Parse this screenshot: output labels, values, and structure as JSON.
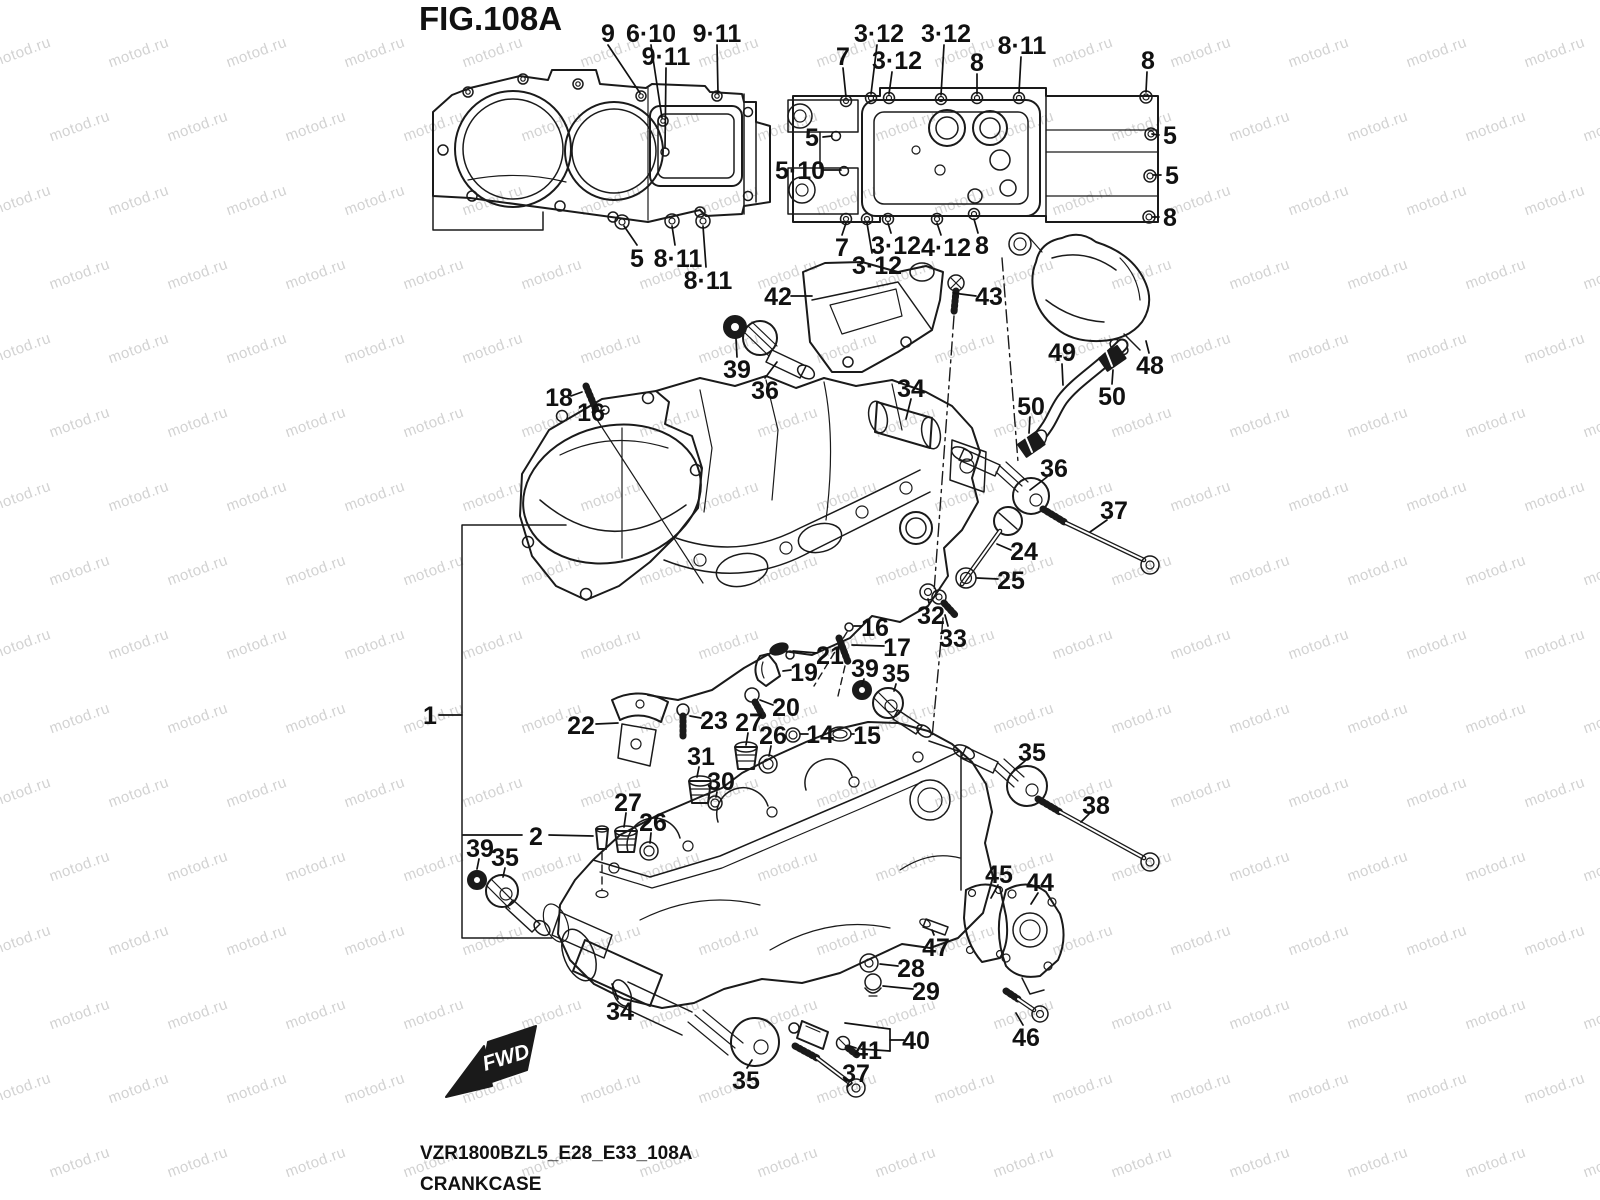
{
  "title": "FIG.108A",
  "footer": {
    "code": "VZR1800BZL5_E28_E33_108A",
    "name": "CRANKCASE"
  },
  "fwd_label": "FWD",
  "watermark": {
    "text": "motod.ru",
    "color": "#d2d2d2",
    "rows": 18,
    "cols": 15,
    "col_step": 118,
    "row_step": 74,
    "row_shift": 59,
    "x_origin": -70,
    "y_origin": -30
  },
  "callouts": [
    {
      "label": "9",
      "x": 608,
      "y": 33,
      "leaders": [
        [
          608,
          45,
          640,
          93
        ]
      ]
    },
    {
      "label": "6·10",
      "x": 651,
      "y": 33,
      "leaders": [
        [
          651,
          45,
          662,
          118
        ]
      ]
    },
    {
      "label": "9·11",
      "x": 717,
      "y": 33,
      "leaders": [
        [
          717,
          45,
          718,
          93
        ]
      ]
    },
    {
      "label": "9·11",
      "x": 666,
      "y": 56,
      "leaders": [
        [
          666,
          68,
          665,
          148
        ]
      ]
    },
    {
      "label": "5·10",
      "x": 800,
      "y": 170,
      "leaders": [
        [
          823,
          170,
          841,
          170
        ]
      ]
    },
    {
      "label": "5",
      "x": 637,
      "y": 258,
      "leaders": [
        [
          637,
          245,
          624,
          226
        ]
      ]
    },
    {
      "label": "8·11",
      "x": 678,
      "y": 258,
      "leaders": [
        [
          675,
          245,
          672,
          226
        ]
      ]
    },
    {
      "label": "8·11",
      "x": 708,
      "y": 280,
      "leaders": [
        [
          706,
          267,
          703,
          226
        ]
      ]
    },
    {
      "label": "7",
      "x": 843,
      "y": 56,
      "leaders": [
        [
          843,
          68,
          846,
          97
        ]
      ]
    },
    {
      "label": "3·12",
      "x": 879,
      "y": 33,
      "leaders": [
        [
          877,
          45,
          871,
          94
        ]
      ]
    },
    {
      "label": "3·12",
      "x": 897,
      "y": 60,
      "leaders": [
        [
          892,
          72,
          889,
          94
        ]
      ]
    },
    {
      "label": "3·12",
      "x": 946,
      "y": 33,
      "leaders": [
        [
          944,
          45,
          941,
          95
        ]
      ]
    },
    {
      "label": "8",
      "x": 977,
      "y": 62,
      "leaders": [
        [
          977,
          74,
          977,
          94
        ]
      ]
    },
    {
      "label": "8·11",
      "x": 1022,
      "y": 45,
      "leaders": [
        [
          1021,
          57,
          1019,
          93
        ]
      ]
    },
    {
      "label": "8",
      "x": 1148,
      "y": 60,
      "leaders": [
        [
          1147,
          72,
          1146,
          92
        ]
      ]
    },
    {
      "label": "5",
      "x": 812,
      "y": 137,
      "leaders": [
        [
          823,
          137,
          832,
          136
        ]
      ]
    },
    {
      "label": "5",
      "x": 1170,
      "y": 135,
      "leaders": [
        [
          1159,
          135,
          1152,
          134
        ]
      ]
    },
    {
      "label": "5",
      "x": 1172,
      "y": 175,
      "leaders": [
        [
          1161,
          175,
          1153,
          175
        ]
      ]
    },
    {
      "label": "8",
      "x": 1170,
      "y": 217,
      "leaders": [
        [
          1159,
          217,
          1152,
          217
        ]
      ]
    },
    {
      "label": "7",
      "x": 842,
      "y": 247,
      "leaders": [
        [
          842,
          235,
          846,
          223
        ]
      ]
    },
    {
      "label": "3·12",
      "x": 896,
      "y": 245,
      "leaders": [
        [
          891,
          233,
          888,
          223
        ]
      ]
    },
    {
      "label": "3·12",
      "x": 877,
      "y": 265,
      "leaders": [
        [
          872,
          253,
          867,
          223
        ]
      ]
    },
    {
      "label": "4·12",
      "x": 946,
      "y": 247,
      "leaders": [
        [
          941,
          235,
          937,
          223
        ]
      ]
    },
    {
      "label": "8",
      "x": 982,
      "y": 245,
      "leaders": [
        [
          978,
          233,
          974,
          219
        ]
      ]
    },
    {
      "label": "42",
      "x": 778,
      "y": 296,
      "leaders": [
        [
          791,
          296,
          812,
          296
        ]
      ]
    },
    {
      "label": "43",
      "x": 989,
      "y": 296,
      "leaders": [
        [
          976,
          296,
          953,
          293
        ]
      ]
    },
    {
      "label": "39",
      "x": 737,
      "y": 369,
      "leaders": [
        [
          737,
          357,
          736,
          339
        ]
      ]
    },
    {
      "label": "36",
      "x": 765,
      "y": 390,
      "leaders": [
        [
          765,
          378,
          777,
          362
        ]
      ]
    },
    {
      "label": "34",
      "x": 911,
      "y": 388,
      "leaders": [
        [
          911,
          399,
          906,
          419
        ]
      ]
    },
    {
      "label": "18",
      "x": 559,
      "y": 397,
      "leaders": [
        [
          571,
          396,
          582,
          392
        ]
      ]
    },
    {
      "label": "16",
      "x": 591,
      "y": 412,
      "leaders": [
        [
          601,
          411,
          604,
          410
        ]
      ]
    },
    {
      "label": "49",
      "x": 1062,
      "y": 352,
      "leaders": [
        [
          1062,
          364,
          1063,
          385
        ]
      ]
    },
    {
      "label": "48",
      "x": 1150,
      "y": 365,
      "leaders": [
        [
          1149,
          353,
          1146,
          341
        ]
      ]
    },
    {
      "label": "50",
      "x": 1112,
      "y": 396,
      "leaders": [
        [
          1112,
          384,
          1113,
          370
        ]
      ]
    },
    {
      "label": "50",
      "x": 1031,
      "y": 406,
      "leaders": [
        [
          1030,
          417,
          1029,
          433
        ]
      ]
    },
    {
      "label": "36",
      "x": 1054,
      "y": 468,
      "leaders": [
        [
          1047,
          477,
          1030,
          490
        ]
      ]
    },
    {
      "label": "37",
      "x": 1114,
      "y": 510,
      "leaders": [
        [
          1107,
          520,
          1090,
          532
        ]
      ]
    },
    {
      "label": "24",
      "x": 1024,
      "y": 551,
      "leaders": [
        [
          1011,
          550,
          997,
          544
        ]
      ]
    },
    {
      "label": "25",
      "x": 1011,
      "y": 580,
      "leaders": [
        [
          998,
          579,
          977,
          578
        ]
      ]
    },
    {
      "label": "32",
      "x": 931,
      "y": 615,
      "leaders": [
        [
          929,
          603,
          928,
          599
        ]
      ]
    },
    {
      "label": "33",
      "x": 953,
      "y": 638,
      "leaders": [
        [
          948,
          626,
          945,
          615
        ]
      ]
    },
    {
      "label": "16",
      "x": 875,
      "y": 627,
      "leaders": [
        [
          862,
          626,
          854,
          626
        ]
      ]
    },
    {
      "label": "17",
      "x": 897,
      "y": 647,
      "leaders": [
        [
          884,
          646,
          852,
          645
        ]
      ]
    },
    {
      "label": "21",
      "x": 830,
      "y": 655,
      "leaders": [
        [
          817,
          653,
          793,
          651
        ]
      ]
    },
    {
      "label": "19",
      "x": 804,
      "y": 672,
      "leaders": [
        [
          791,
          670,
          783,
          671
        ]
      ]
    },
    {
      "label": "39",
      "x": 865,
      "y": 668,
      "leaders": [
        [
          864,
          679,
          862,
          685
        ]
      ]
    },
    {
      "label": "35",
      "x": 896,
      "y": 673,
      "leaders": [
        [
          896,
          684,
          894,
          691
        ]
      ]
    },
    {
      "label": "20",
      "x": 786,
      "y": 707,
      "leaders": [
        [
          773,
          705,
          760,
          700
        ]
      ]
    },
    {
      "label": "22",
      "x": 581,
      "y": 725,
      "leaders": [
        [
          596,
          724,
          618,
          723
        ]
      ]
    },
    {
      "label": "23",
      "x": 714,
      "y": 720,
      "leaders": [
        [
          701,
          718,
          690,
          716
        ]
      ]
    },
    {
      "label": "27",
      "x": 749,
      "y": 722,
      "leaders": [
        [
          748,
          733,
          746,
          745
        ]
      ]
    },
    {
      "label": "26",
      "x": 773,
      "y": 735,
      "leaders": [
        [
          771,
          746,
          769,
          756
        ]
      ]
    },
    {
      "label": "14",
      "x": 820,
      "y": 734,
      "leaders": [
        [
          808,
          734,
          800,
          734
        ]
      ]
    },
    {
      "label": "15",
      "x": 867,
      "y": 735,
      "leaders": [
        [
          854,
          734,
          851,
          734
        ]
      ]
    },
    {
      "label": "31",
      "x": 701,
      "y": 756,
      "leaders": [
        [
          699,
          767,
          697,
          777
        ]
      ]
    },
    {
      "label": "30",
      "x": 721,
      "y": 781,
      "leaders": [
        [
          717,
          792,
          716,
          797
        ]
      ]
    },
    {
      "label": "27",
      "x": 628,
      "y": 802,
      "leaders": [
        [
          626,
          813,
          624,
          827
        ]
      ]
    },
    {
      "label": "26",
      "x": 653,
      "y": 822,
      "leaders": [
        [
          651,
          833,
          650,
          843
        ]
      ]
    },
    {
      "label": "2",
      "x": 536,
      "y": 836,
      "leaders": [
        [
          463,
          835,
          522,
          835
        ],
        [
          549,
          835,
          593,
          836
        ]
      ]
    },
    {
      "label": "39",
      "x": 480,
      "y": 848,
      "leaders": [
        [
          479,
          859,
          477,
          869
        ]
      ]
    },
    {
      "label": "35",
      "x": 505,
      "y": 857,
      "leaders": [
        [
          505,
          868,
          503,
          877
        ]
      ]
    },
    {
      "label": "1",
      "x": 430,
      "y": 715,
      "leaders": [
        [
          439,
          715,
          462,
          715
        ]
      ]
    },
    {
      "label": "35",
      "x": 1032,
      "y": 752,
      "leaders": [
        [
          1025,
          761,
          1014,
          770
        ]
      ]
    },
    {
      "label": "38",
      "x": 1096,
      "y": 805,
      "leaders": [
        [
          1089,
          814,
          1081,
          822
        ]
      ]
    },
    {
      "label": "45",
      "x": 999,
      "y": 874,
      "leaders": [
        [
          998,
          885,
          991,
          898
        ]
      ]
    },
    {
      "label": "44",
      "x": 1040,
      "y": 882,
      "leaders": [
        [
          1038,
          893,
          1031,
          904
        ]
      ]
    },
    {
      "label": "47",
      "x": 936,
      "y": 947,
      "leaders": [
        [
          934,
          935,
          932,
          930
        ]
      ]
    },
    {
      "label": "28",
      "x": 911,
      "y": 968,
      "leaders": [
        [
          898,
          966,
          880,
          964
        ]
      ]
    },
    {
      "label": "29",
      "x": 926,
      "y": 991,
      "leaders": [
        [
          913,
          989,
          883,
          986
        ]
      ]
    },
    {
      "label": "40",
      "x": 916,
      "y": 1040,
      "leaders": [
        [
          904,
          1040,
          890,
          1040
        ],
        [
          890,
          1029,
          890,
          1051
        ],
        [
          890,
          1029,
          845,
          1023
        ],
        [
          890,
          1051,
          861,
          1049
        ]
      ]
    },
    {
      "label": "41",
      "x": 868,
      "y": 1050,
      "leaders": [
        [
          856,
          1048,
          850,
          1046
        ]
      ]
    },
    {
      "label": "37",
      "x": 856,
      "y": 1073,
      "leaders": [
        [
          852,
          1083,
          847,
          1087
        ]
      ]
    },
    {
      "label": "34",
      "x": 620,
      "y": 1011,
      "leaders": [
        [
          618,
          999,
          612,
          984
        ]
      ]
    },
    {
      "label": "35",
      "x": 746,
      "y": 1080,
      "leaders": [
        [
          747,
          1068,
          752,
          1060
        ]
      ]
    },
    {
      "label": "46",
      "x": 1026,
      "y": 1037,
      "leaders": [
        [
          1023,
          1025,
          1016,
          1013
        ]
      ]
    }
  ]
}
